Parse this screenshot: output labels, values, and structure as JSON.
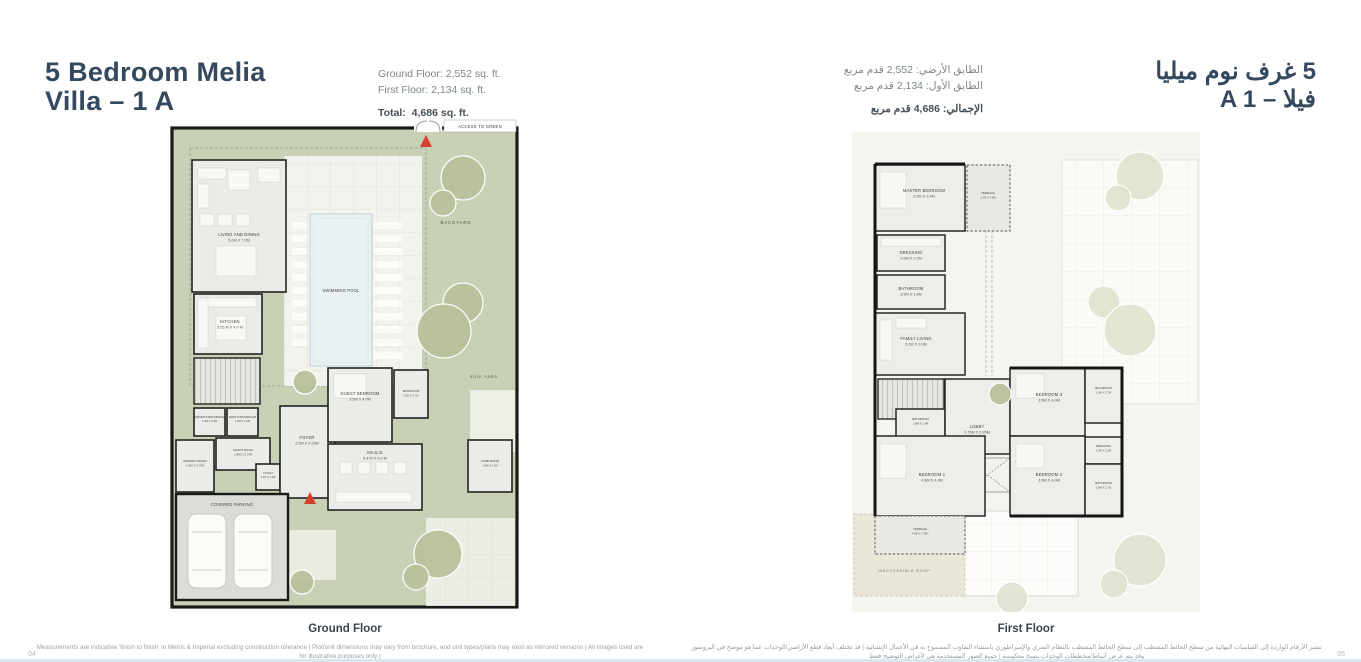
{
  "header": {
    "title_en_line1": "5 Bedroom Melia",
    "title_en_line2": "Villa – 1 A",
    "title_ar_line1": "5 غرف نوم ميليا",
    "title_ar_line2": "فيلا – A 1"
  },
  "stats_en": {
    "ground_floor": "Ground Floor: 2,552 sq. ft.",
    "first_floor": "First Floor: 2,134 sq. ft.",
    "total_label": "Total:",
    "total_value": "4,686 sq. ft."
  },
  "stats_ar": {
    "ground_floor": "الطابق الأرضي: 2,552 قدم مربع",
    "first_floor": "الطابق الأول: 2,134 قدم مربع",
    "total": "الإجمالي: 4,686 قدم مربع"
  },
  "ground_floor": {
    "caption": "Ground Floor",
    "access_label": "ACCESS TO GREEN",
    "areas": {
      "backyard": "BACKYARD",
      "side_yard": "SIDE YARD",
      "swimming_pool": "SWIMMING POOL",
      "covered_parking": "COVERED PARKING"
    },
    "rooms": [
      {
        "label": "LIVING AND DINING",
        "dims": "5.0M X 7.2M"
      },
      {
        "label": "KITCHEN",
        "dims": "3.55 M X 4.0 M"
      },
      {
        "label": "DRIVER'S BATHROOM",
        "dims": "1.2M X 1.6M"
      },
      {
        "label": "MAID'S BATHROOM",
        "dims": "1.2M X 1.6M"
      },
      {
        "label": "MAID'S ROOM",
        "dims": "1.85M X 2.75M"
      },
      {
        "label": "DRIVER'S ROOM",
        "dims": "1.85M X 2.75M"
      },
      {
        "label": "TOILET",
        "dims": "1.5M X 1.9M"
      },
      {
        "label": "FOYER",
        "dims": "2.5M X 4.29M"
      },
      {
        "label": "GUEST BEDROOM",
        "dims": "3.5M X 4.0M"
      },
      {
        "label": "BATHROOM",
        "dims": "1.8M X 2.7M"
      },
      {
        "label": "MAJLIS",
        "dims": "5.4 M X 4.0 M"
      },
      {
        "label": "PUMP ROOM",
        "dims": "1.8M X 3.0M"
      }
    ]
  },
  "first_floor": {
    "caption": "First Floor",
    "areas": {
      "inaccessible_roof": "INACCESSIBLE ROOF"
    },
    "rooms": [
      {
        "label": "MASTER BEDROOM",
        "dims": "5.2M X 3.4M"
      },
      {
        "label": "TERRACE",
        "dims": "2.3M X 3.9M"
      },
      {
        "label": "DRESSING",
        "dims": "3.9M X 2.2M"
      },
      {
        "label": "BATHROOM",
        "dims": "3.9M X 1.8M"
      },
      {
        "label": "FAMILY LIVING",
        "dims": "5.2M X 3.0M"
      },
      {
        "label": "BATHROOM",
        "dims": "2.9M X 1.4M"
      },
      {
        "label": "LOBBY",
        "dims": "3.75M X 2.85M"
      },
      {
        "label": "BEDROOM 3",
        "dims": "3.5M X 4.0M"
      },
      {
        "label": "BATHROOM",
        "dims": "1.8M X 2.7M"
      },
      {
        "label": "DRESSING",
        "dims": "1.9M X 1.9M"
      },
      {
        "label": "BEDROOM 2",
        "dims": "3.5M X 4.0M"
      },
      {
        "label": "BATHROOM",
        "dims": "1.8M X 2.7M"
      },
      {
        "label": "BEDROOM 1",
        "dims": "4.8M X 4.3M"
      },
      {
        "label": "TERRACE",
        "dims": "4.9M X 1.75M"
      }
    ]
  },
  "footer": {
    "disclaimer_en_line1": "Measurements are indicative 'finish to finish' in Metric & Imperial excluding construction tolerance | Plot/unit dimensions may vary from brochure, and unit types/plans may exist as mirrored versions | All images used are for illustrative purposes only |",
    "disclaimer_en_line2": "Unless stated otherwise, all fittings and interior decorative items shown are for illustrative purposes only | The developer reserves the right to make alterations, at its absolute discretion, without any liability whatsoever up to the final 'as built' status.",
    "disclaimer_ar_line1": "تشير الأرقام الواردة إلى القياسات النهائية من سطح الحائط المشطب إلى سطح الحائط المشطب بالنظام المتري والإمبراطوري باستثناء التفاوت المسموح به في الأعمال الإنشائية | قد تختلف أبعاد قطع الأراضي/الوحدات عما هو موضح في البروشور وقد يتم عرض أنماط/مخططات الوحدات بنسخ معكوسة | جميع الصور المستخدمة هي لأغراض التوضيح فقط",
    "disclaimer_ar_line2": "جميع التجهيزات والديكورات الداخلية الواردة هي لأغراض التوضيح فقط ما لم يُذكر خلاف ذلك صراحة | يحتفظ المطور وفقاً لتقديره المطلق بحق إجراء التعديلات دون أدنى مسؤولية حتى الوضع النهائي كما تم البناء",
    "page_number_left": "04",
    "page_number_right": "05"
  },
  "colors": {
    "accent_navy": "#34495d",
    "yard_green": "#c8d1b6",
    "marker_red": "#d4402b",
    "roof_beige": "#eae7d8"
  }
}
